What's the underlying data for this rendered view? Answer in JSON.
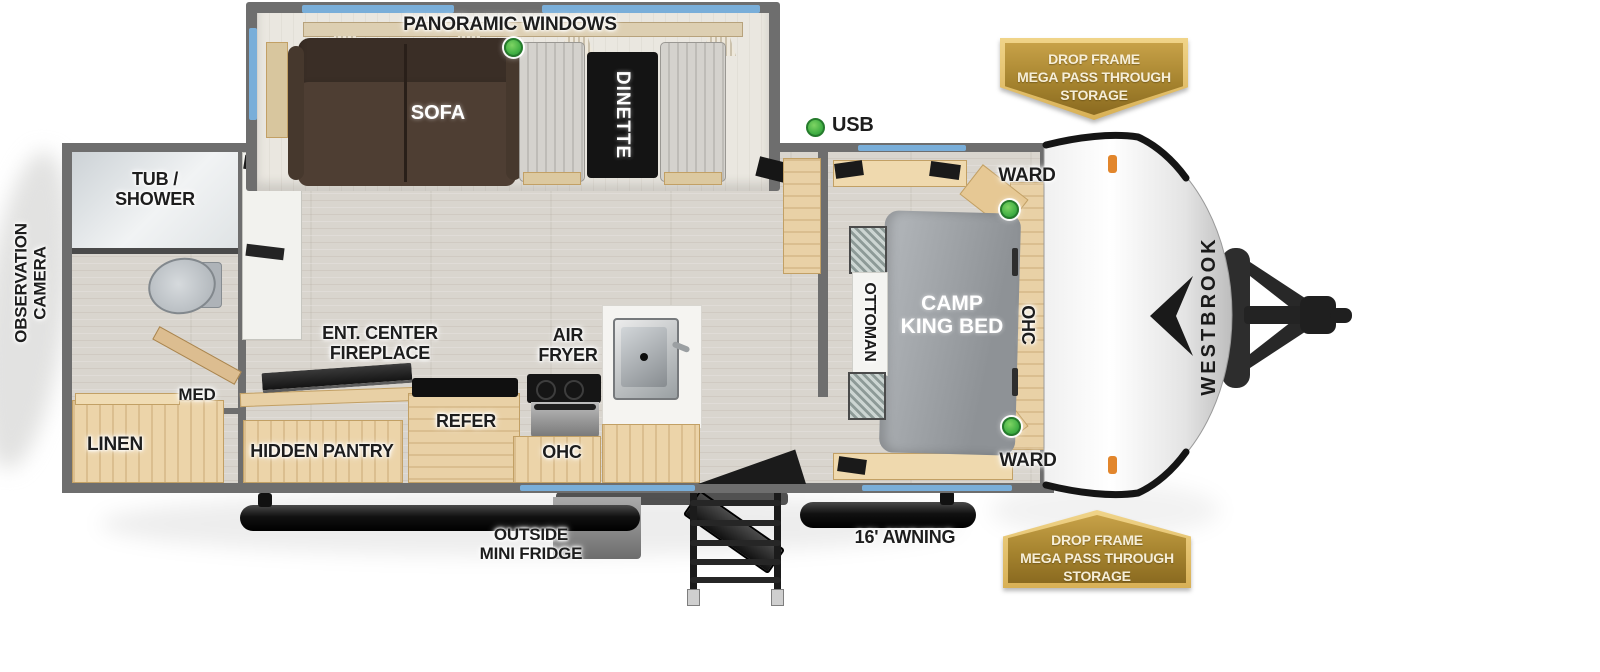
{
  "meta": {
    "title": "Westbrook travel trailer floor plan"
  },
  "brand": {
    "name": "WESTBROOK"
  },
  "callouts": {
    "panoramic_windows": "PANORAMIC WINDOWS",
    "usb": "USB",
    "observation_camera": [
      "OBSERVATION",
      "CAMERA"
    ],
    "outside_mini_fridge": [
      "OUTSIDE",
      "MINI FRIDGE"
    ],
    "awning": "16' AWNING"
  },
  "badges": {
    "pass_through_top": [
      "DROP FRAME",
      "MEGA PASS THROUGH",
      "STORAGE"
    ],
    "pass_through_bottom": [
      "DROP FRAME",
      "MEGA PASS THROUGH",
      "STORAGE"
    ]
  },
  "living": {
    "sofa": "SOFA",
    "dinette": "DINETTE",
    "ent_center": [
      "ENT. CENTER",
      "FIREPLACE"
    ],
    "hidden_pantry": "HIDDEN PANTRY",
    "refer": "REFER",
    "ohc": "OHC",
    "air_fryer": [
      "AIR",
      "FRYER"
    ]
  },
  "bath": {
    "tub_shower": [
      "TUB /",
      "SHOWER"
    ],
    "med": "MED",
    "linen": "LINEN"
  },
  "bedroom": {
    "ward_top": "WARD",
    "bed": [
      "CAMP",
      "KING BED"
    ],
    "ottoman": "OTTOMAN",
    "ohc": "OHC",
    "ward_bottom": "WARD"
  },
  "colors": {
    "wall_gray": "#6e6e6e",
    "window_blue": "#79aed9",
    "cabinet_wood": "#ecd4a9",
    "badge_gold": "#a5832e",
    "indicator_green": "#3fae43",
    "sofa_brown": "#4c3c31",
    "bed_gray": "#9aa0a5"
  }
}
